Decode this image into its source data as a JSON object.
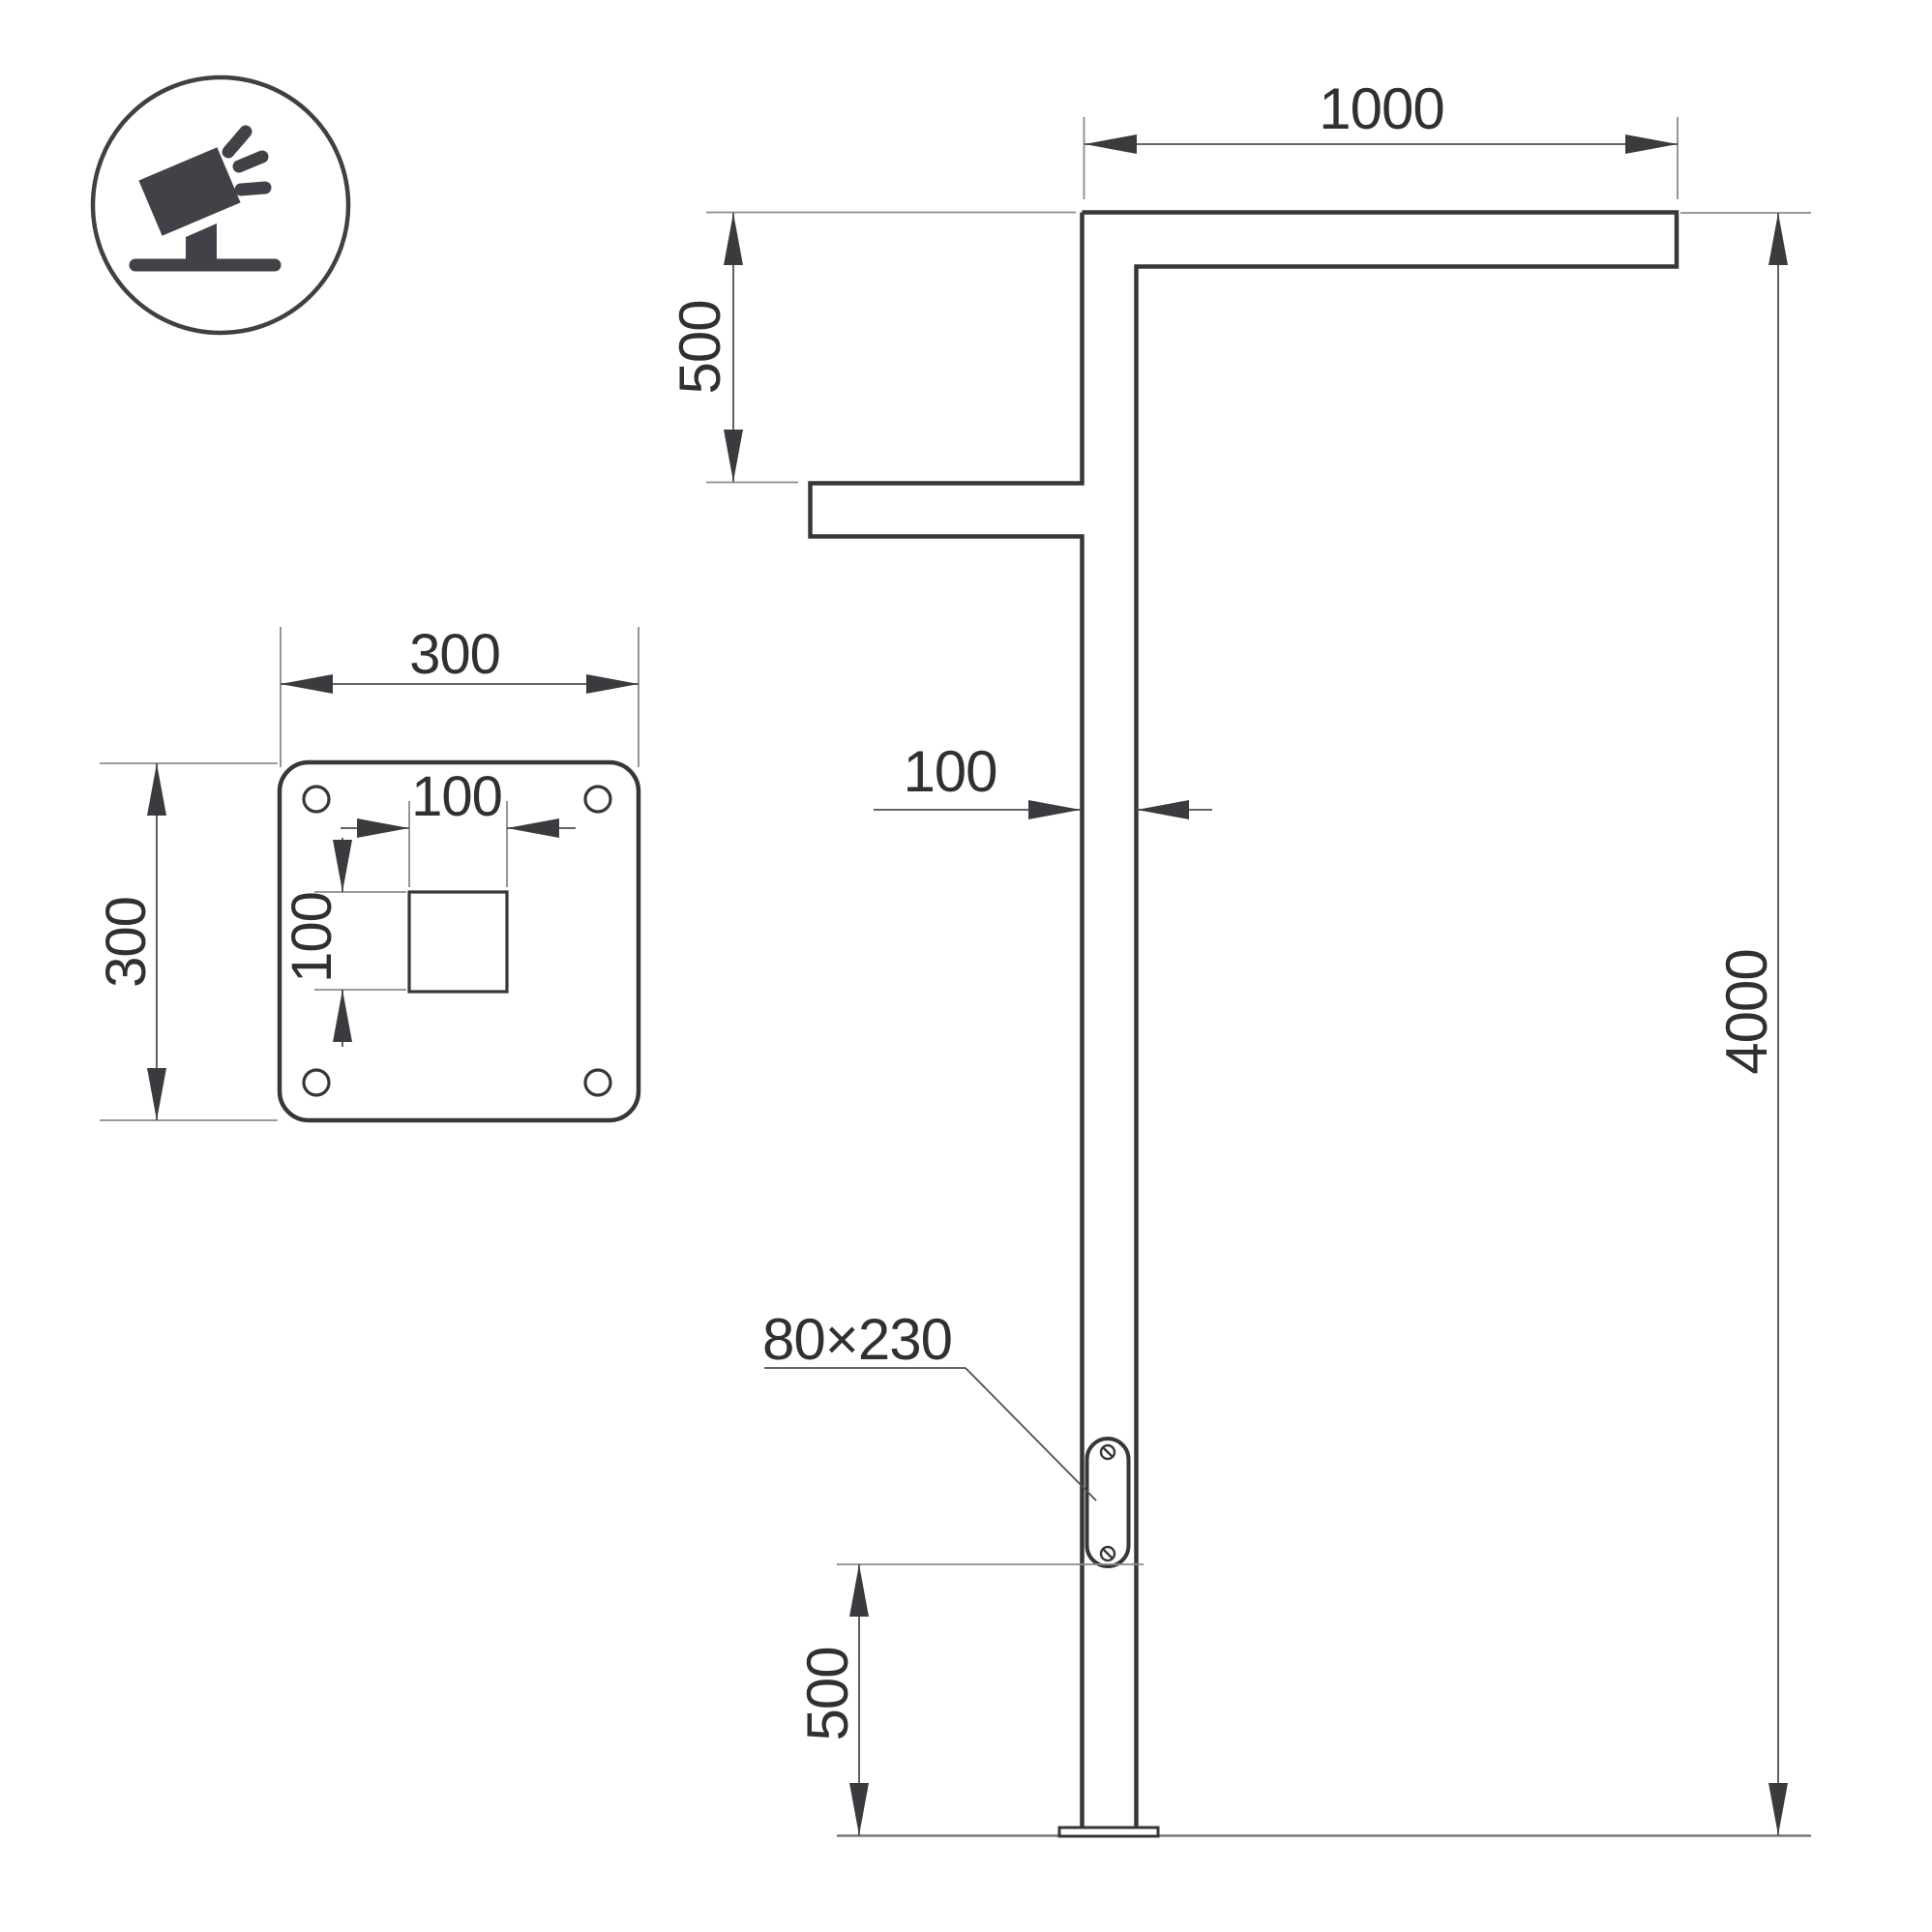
{
  "drawing": {
    "title": "street-pole-dimension-drawing",
    "view_elevation": {
      "arm_length": "1000",
      "arm_vertical_offset": "500",
      "pole_width": "100",
      "total_height": "4000",
      "service_door_size": "80×230",
      "door_bottom_offset": "500"
    },
    "view_base_plate": {
      "plate_width": "300",
      "plate_height": "300",
      "cutout_width": "100",
      "cutout_height": "100"
    },
    "icon": {
      "name": "floodlight-on-pole-icon"
    },
    "colors": {
      "outline": "#36373a",
      "dimension_line": "#4e4f52",
      "extension_line": "#8a8b8e",
      "text": "#2f3033",
      "icon": "#414247",
      "background": "#ffffff"
    }
  }
}
